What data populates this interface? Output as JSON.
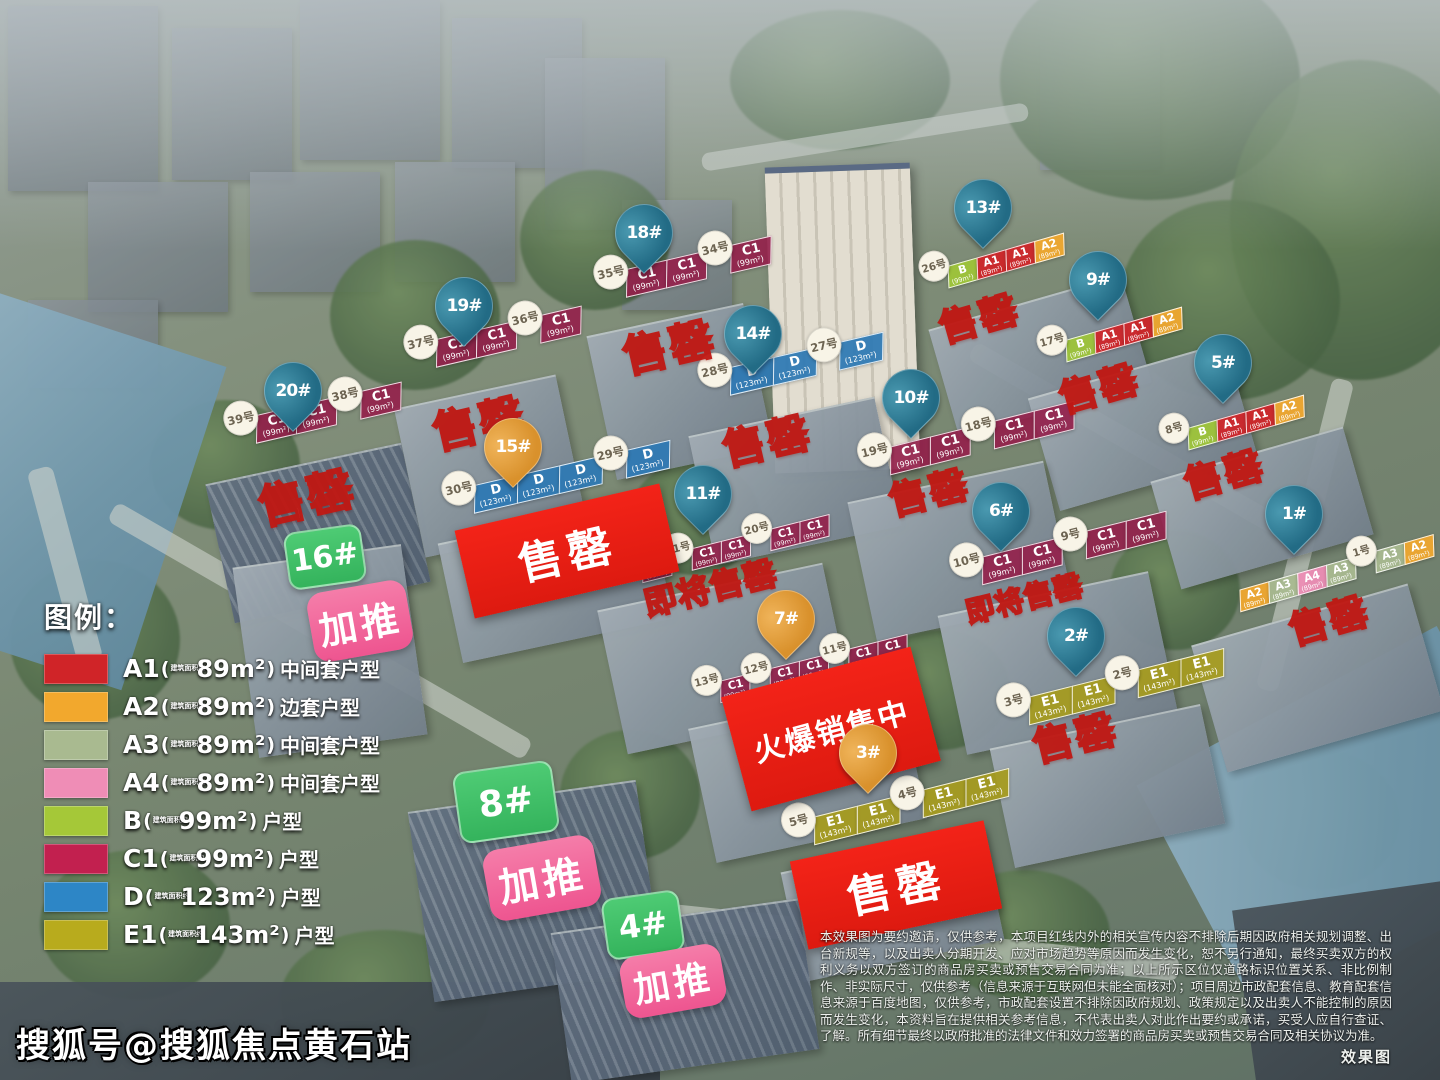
{
  "watermark": "搜狐号@搜狐焦点黄石站",
  "render_note": "效果图",
  "legend": {
    "title": "图例：",
    "items": [
      {
        "code": "A1",
        "qualifier": "建筑面积约",
        "area": "89m²",
        "desc": "中间套户型",
        "color": "#d02428"
      },
      {
        "code": "A2",
        "qualifier": "建筑面积约",
        "area": "89m²",
        "desc": "边套户型",
        "color": "#f2a82d"
      },
      {
        "code": "A3",
        "qualifier": "建筑面积约",
        "area": "89m²",
        "desc": "中间套户型",
        "color": "#a9ba90"
      },
      {
        "code": "A4",
        "qualifier": "建筑面积约",
        "area": "89m²",
        "desc": "中间套户型",
        "color": "#ef8db6"
      },
      {
        "code": "B",
        "qualifier": "建筑面积约",
        "area": "99m²",
        "desc": "户型",
        "color": "#a5c838"
      },
      {
        "code": "C1",
        "qualifier": "建筑面积约",
        "area": "99m²",
        "desc": "户型",
        "color": "#c2204f"
      },
      {
        "code": "D",
        "qualifier": "建筑面积约",
        "area": "123m²",
        "desc": "户型",
        "color": "#2d86c6"
      },
      {
        "code": "E1",
        "qualifier": "建筑面积约",
        "area": "143m²",
        "desc": "户型",
        "color": "#b8ab1d"
      }
    ]
  },
  "disclaimer": "本效果图为要约邀请，仅供参考，本项目红线内外的相关宣传内容不排除后期因政府相关规划调整、出台新规等，以及出卖人分期开发、应对市场趋势等原因而发生变化，恕不另行通知，最终买卖双方的权利义务以双方签订的商品房买卖或预售交易合同为准；以上所示区位仅道路标识位置关系、非比例制作、非实际尺寸，仅供参考（信息来源于互联网但未能全面核对）；项目周边市政配套信息、教育配套信息来源于百度地图，仅供参考，市政配套设置不排除因政府规划、政策规定以及出卖人不能控制的原因而发生变化，本资料旨在提供相关参考信息，不代表出卖人对此作出要约或承诺，买受人应自行查证、了解。所有细节最终以政府批准的法律文件和效力签署的商品房买卖或预售交易合同及相关协议为准。",
  "buildings": {
    "b20": {
      "pin": "20#",
      "status": "售罄",
      "strip": [
        {
          "badge": "39号"
        },
        {
          "code": "C1",
          "area": "(99m²)"
        },
        {
          "code": "C1",
          "area": "(99m²)"
        },
        {
          "badge": "38号"
        },
        {
          "code": "C1",
          "area": "(99m²)"
        }
      ]
    },
    "b19": {
      "pin": "19#",
      "status": "售罄",
      "strip": [
        {
          "badge": "37号"
        },
        {
          "code": "C1",
          "area": "(99m²)"
        },
        {
          "code": "C1",
          "area": "(99m²)"
        },
        {
          "badge": "36号"
        },
        {
          "code": "C1",
          "area": "(99m²)"
        }
      ]
    },
    "b18": {
      "pin": "18#",
      "status": "售罄",
      "strip": [
        {
          "badge": "35号"
        },
        {
          "code": "C1",
          "area": "(99m²)"
        },
        {
          "code": "C1",
          "area": "(99m²)"
        },
        {
          "badge": "34号"
        },
        {
          "code": "C1",
          "area": "(99m²)"
        }
      ]
    },
    "b15": {
      "pin": "15#",
      "status": "售罄",
      "strip": [
        {
          "badge": "30号"
        },
        {
          "code": "D",
          "area": "(123m²)"
        },
        {
          "code": "D",
          "area": "(123m²)"
        },
        {
          "code": "D",
          "area": "(123m²)"
        },
        {
          "badge": "29号"
        },
        {
          "code": "D",
          "area": "(123m²)"
        }
      ]
    },
    "b14": {
      "pin": "14#",
      "status": "售罄",
      "strip": [
        {
          "badge": "28号"
        },
        {
          "code": "D",
          "area": "(123m²)"
        },
        {
          "code": "D",
          "area": "(123m²)"
        },
        {
          "badge": "27号"
        },
        {
          "code": "D",
          "area": "(123m²)"
        }
      ]
    },
    "b13": {
      "pin": "13#",
      "status": "售罄",
      "strip": [
        {
          "badge": "26号"
        },
        {
          "code": "B",
          "area": "(99m²)"
        },
        {
          "code": "A1",
          "area": "(89m²)"
        },
        {
          "code": "A1",
          "area": "(89m²)"
        },
        {
          "code": "A2",
          "area": "(89m²)"
        }
      ]
    },
    "b11": {
      "pin": "11#",
      "status": "即将售罄",
      "strip": [
        {
          "badge": "22号"
        },
        {
          "code": "C1",
          "area": "(99m²)"
        },
        {
          "badge": "21号"
        },
        {
          "code": "C1",
          "area": "(99m²)"
        },
        {
          "code": "C1",
          "area": "(99m²)"
        },
        {
          "badge": "20号"
        },
        {
          "code": "C1",
          "area": "(99m²)"
        },
        {
          "code": "C1",
          "area": "(99m²)"
        }
      ]
    },
    "b10": {
      "pin": "10#",
      "status": "售罄",
      "strip": [
        {
          "badge": "19号"
        },
        {
          "code": "C1",
          "area": "(99m²)"
        },
        {
          "code": "C1",
          "area": "(99m²)"
        },
        {
          "badge": "18号"
        },
        {
          "code": "C1",
          "area": "(99m²)"
        },
        {
          "code": "C1",
          "area": "(99m²)"
        }
      ]
    },
    "b9": {
      "pin": "9#",
      "status": "售罄",
      "strip": [
        {
          "badge": "17号"
        },
        {
          "code": "B",
          "area": "(99m²)"
        },
        {
          "code": "A1",
          "area": "(89m²)"
        },
        {
          "code": "A1",
          "area": "(89m²)"
        },
        {
          "code": "A2",
          "area": "(89m²)"
        }
      ]
    },
    "b7": {
      "pin": "7#",
      "status": "火爆销售中",
      "strip": [
        {
          "badge": "13号"
        },
        {
          "code": "C1",
          "area": "(99m²)"
        },
        {
          "badge": "12号"
        },
        {
          "code": "C1",
          "area": "(99m²)"
        },
        {
          "code": "C1",
          "area": "(99m²)"
        },
        {
          "badge": "11号"
        },
        {
          "code": "C1",
          "area": "(99m²)"
        },
        {
          "code": "C1",
          "area": "(99m²)"
        }
      ]
    },
    "b6": {
      "pin": "6#",
      "status": "即将售罄",
      "strip": [
        {
          "badge": "10号"
        },
        {
          "code": "C1",
          "area": "(99m²)"
        },
        {
          "code": "C1",
          "area": "(99m²)"
        },
        {
          "badge": "9号"
        },
        {
          "code": "C1",
          "area": "(99m²)"
        },
        {
          "code": "C1",
          "area": "(99m²)"
        }
      ]
    },
    "b5": {
      "pin": "5#",
      "status": "售罄",
      "strip": [
        {
          "badge": "8号"
        },
        {
          "code": "B",
          "area": "(99m²)"
        },
        {
          "code": "A1",
          "area": "(89m²)"
        },
        {
          "code": "A1",
          "area": "(89m²)"
        },
        {
          "code": "A2",
          "area": "(89m²)"
        }
      ]
    },
    "b3": {
      "pin": "3#",
      "status": "售罄",
      "strip": [
        {
          "badge": "5号"
        },
        {
          "code": "E1",
          "area": "(143m²)"
        },
        {
          "code": "E1",
          "area": "(143m²)"
        },
        {
          "badge": "4号"
        },
        {
          "code": "E1",
          "area": "(143m²)"
        },
        {
          "code": "E1",
          "area": "(143m²)"
        }
      ]
    },
    "b2": {
      "pin": "2#",
      "status": "售罄",
      "strip": [
        {
          "badge": "3号"
        },
        {
          "code": "E1",
          "area": "(143m²)"
        },
        {
          "code": "E1",
          "area": "(143m²)"
        },
        {
          "badge": "2号"
        },
        {
          "code": "E1",
          "area": "(143m²)"
        },
        {
          "code": "E1",
          "area": "(143m²)"
        }
      ]
    },
    "b1": {
      "pin": "1#",
      "status": "售罄",
      "strip": [
        {
          "code": "A2",
          "area": "(89m²)"
        },
        {
          "code": "A3",
          "area": "(89m²)"
        },
        {
          "code": "A4",
          "area": "(89m²)"
        },
        {
          "code": "A3",
          "area": "(89m²)"
        },
        {
          "badge": "1号"
        },
        {
          "code": "A3",
          "area": "(89m²)"
        },
        {
          "code": "A2",
          "area": "(89m²)"
        }
      ]
    },
    "b16": {
      "tag": "16#",
      "promo": "加推"
    },
    "b8": {
      "tag": "8#",
      "promo": "加推"
    },
    "b4": {
      "tag": "4#",
      "promo": "加推"
    }
  }
}
